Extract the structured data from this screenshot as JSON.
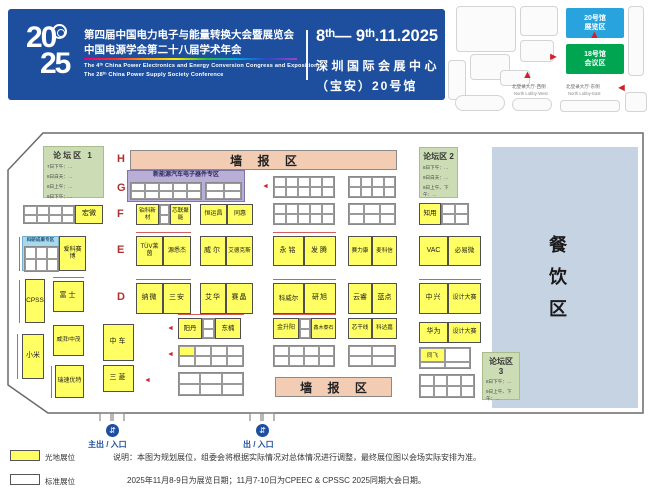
{
  "header": {
    "logo_top": "20",
    "logo_bottom": "25",
    "title_cn1": "第四届中国电力电子与能量转换大会暨展览会",
    "title_cn2": "中国电源学会第二十八届学术年会",
    "title_en1": "The 4ᵗʰ China Power Electronics and Energy Conversion Congress and Exposition",
    "title_en2": "The 28ᵗʰ China Power Supply Society Conference",
    "date": "8ᵗʰ— 9ᵗʰ.11.2025",
    "venue_line1": "深圳国际会展中心",
    "venue_line2": "（宝安）20号馆"
  },
  "minimap": {
    "hall20_line1": "20号馆",
    "hall20_line2": "展览区",
    "hall18_line1": "18号馆",
    "hall18_line2": "会议区",
    "lobby_west_cn": "北登录大厅-西侧",
    "lobby_west_en": "North Lobby-West",
    "lobby_east_cn": "北登录大厅-东侧",
    "lobby_east_en": "North Lobby-East"
  },
  "plan": {
    "letters": [
      "H",
      "G",
      "F",
      "E",
      "D",
      "C",
      "B",
      "A"
    ],
    "poster_top": "墙 报 区",
    "poster_bottom": "墙 报 区",
    "nev_zone": "新能源汽车电子器件专区",
    "research_zone": "科研成果专区",
    "dining": "餐饮区",
    "forum1": {
      "title": "论坛区 1",
      "lines": [
        "7日下午：…",
        "8日白天：…",
        "8日上午：…",
        "9日下午：…"
      ]
    },
    "forum2": {
      "title": "论坛区 2",
      "lines": [
        "8日下午：…",
        "9日白天：…",
        "9日上午、下午：…"
      ]
    },
    "forum3": {
      "title": "论坛区 3",
      "lines": [
        "8日下午：…",
        "9日上午、下午：…"
      ]
    },
    "booths": {
      "F": [
        "宏微",
        "铂科新材",
        "芯联聚能",
        "恒运昌",
        "同惠",
        "知用"
      ],
      "E": [
        "爱科赛博",
        "TÜV莱茵",
        "源悉杰",
        "威尔",
        "艾德克斯",
        "永铭",
        "发腾",
        "赛力康",
        "麦科信",
        "VAC",
        "必易微"
      ],
      "D": [
        "CPSS",
        "富士",
        "纳微",
        "三安",
        "艾华",
        "赛晶",
        "科威尔",
        "研旭",
        "云睿",
        "蓝点",
        "中兴",
        "设计大赛"
      ],
      "C": [
        "威湃/中茂",
        "小米",
        "中车",
        "阳丹",
        "东楠",
        "金升阳",
        "鑫木泰石",
        "芯干线",
        "科达嘉",
        "华为",
        "设计大赛"
      ],
      "B": [
        "同飞"
      ],
      "A": [
        "瑞速优特",
        "三菱"
      ]
    }
  },
  "entrances": {
    "main": "主出 / 入口",
    "side": "出 / 入口"
  },
  "legend": {
    "raw_space": "光地展位",
    "standard": "标准展位"
  },
  "notes": {
    "line1": "说明：本图为规划展位，组委会将根据实际情况对总体情况进行调整，最终展位图以会场实际安排为准。",
    "line2": "2025年11月8-9日为展览日期；11月7-10日为CPEEC & CPSSC 2025同期大会日期。"
  },
  "icons": {
    "arrow_left": "◄",
    "arrow_up": "▲",
    "arrow_right": "►",
    "entrance": "⇵"
  },
  "colors": {
    "banner_blue": "#1d4f9e",
    "booth_yellow": "#ffff63",
    "poster_pink": "#f2cdb4",
    "nev_purple": "#b9aed6",
    "research_blue": "#a8d9ef",
    "forum_green": "#ccdcb4",
    "dining_blue": "#c5d3e2",
    "accent_red": "#cc2229",
    "map_blue": "#29a3dd",
    "map_green": "#00a551"
  }
}
